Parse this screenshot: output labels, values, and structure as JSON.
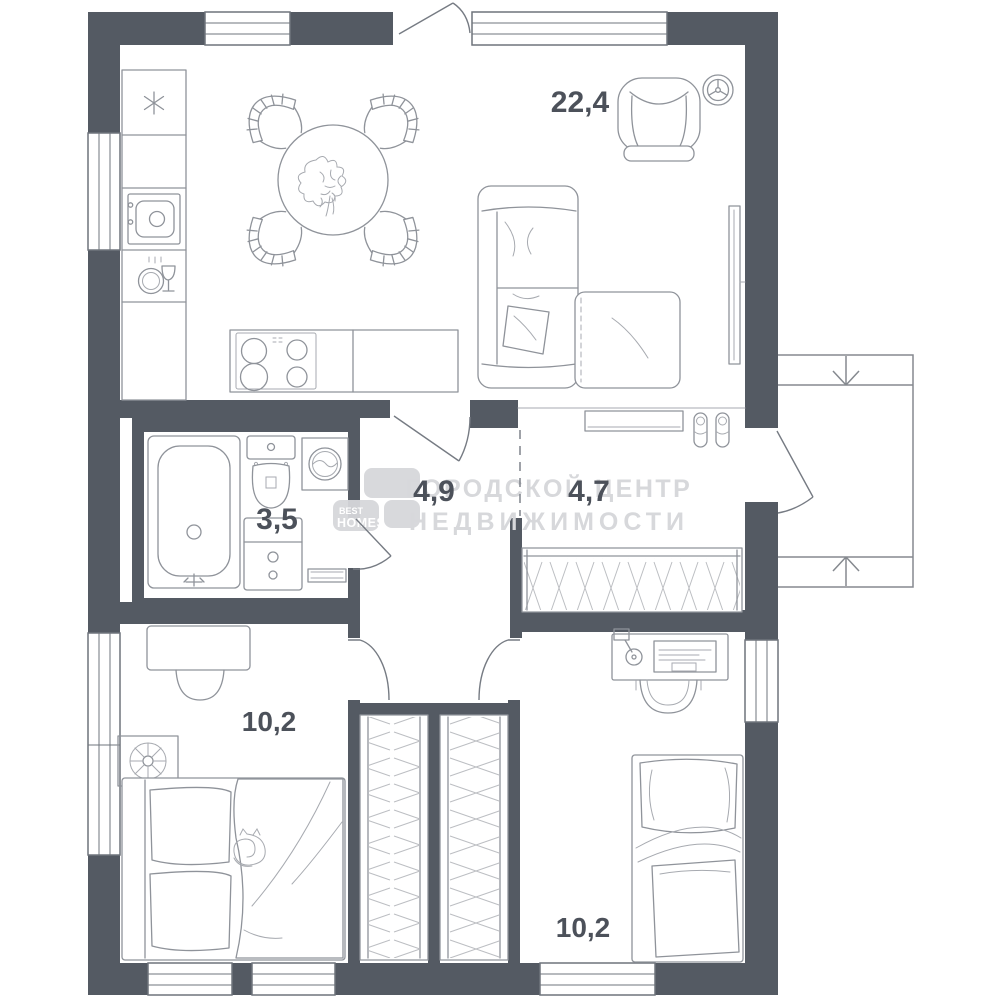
{
  "title": "apartment-floor-plan",
  "rooms": [
    {
      "id": "living-kitchen",
      "area": "22,4"
    },
    {
      "id": "bathroom",
      "area": "3,5"
    },
    {
      "id": "hallway",
      "area": "4,9"
    },
    {
      "id": "entry-hall",
      "area": "4,7"
    },
    {
      "id": "bedroom-left",
      "area": "10,2"
    },
    {
      "id": "bedroom-right",
      "area": "10,2"
    }
  ],
  "watermark": {
    "logo_top": "BEST",
    "logo_bottom": "HOMES",
    "line1": "ГОРОДСКОЙ ЦЕНТР",
    "line2": "НЕДВИЖИМОСТИ"
  },
  "colors": {
    "wall": "#545a63",
    "furniture_stroke": "#8f939a",
    "label": "#4c515a",
    "watermark_text": "#d7d8db",
    "logo_block": "#d6d7da"
  },
  "icons": [
    "snowflake-fridge-icon",
    "sink-icon",
    "dishwasher-icon",
    "stove-icon",
    "dining-table-icon",
    "ceiling-fan-icon",
    "armchair-icon",
    "sofa-icon",
    "tv-icon",
    "shoes-icon",
    "console-shelf-icon",
    "wardrobe-icon",
    "closet-icon",
    "bathtub-icon",
    "toilet-icon",
    "washing-machine-icon",
    "vanity-icon",
    "bed-icon",
    "cat-icon",
    "plant-icon",
    "desk-icon",
    "desk-chair-icon",
    "computer-icon",
    "lamp-icon",
    "entry-arrow-down-icon",
    "entry-arrow-up-icon"
  ]
}
